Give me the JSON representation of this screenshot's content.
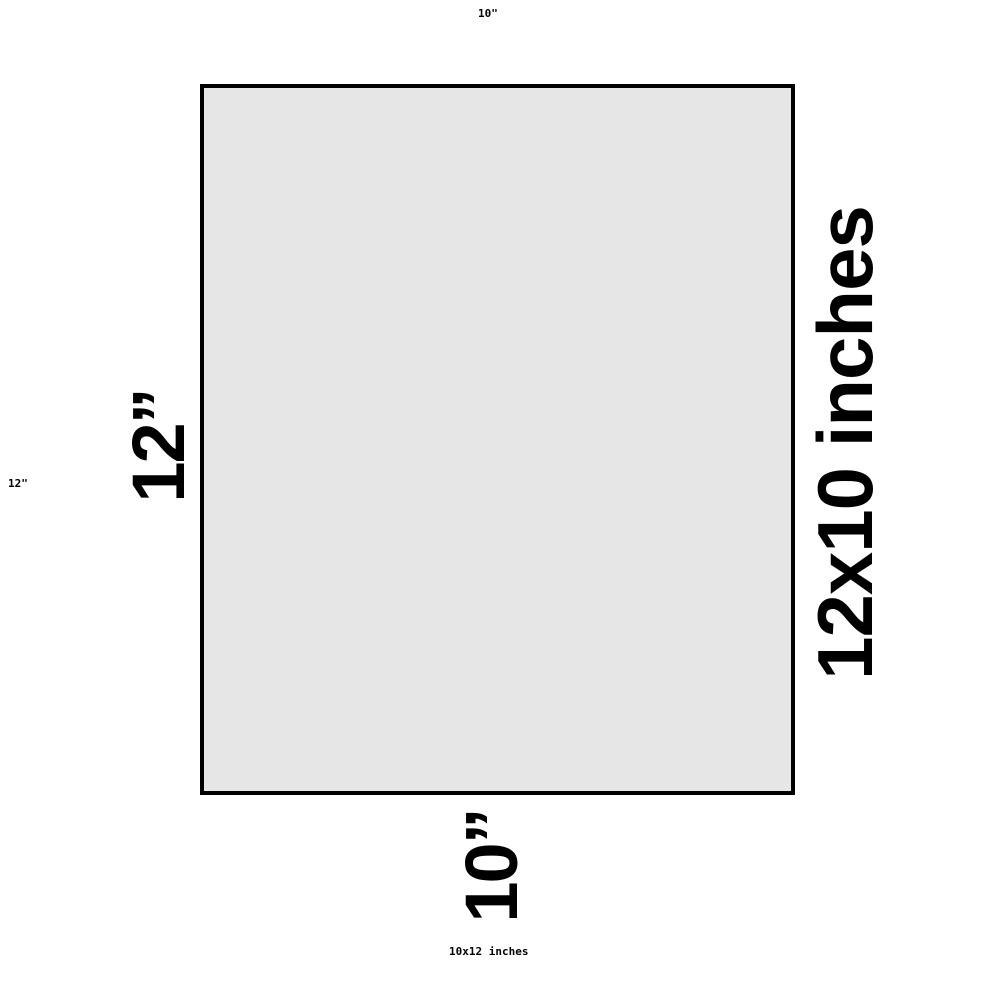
{
  "canvas": {
    "background": "#ffffff"
  },
  "rectangle": {
    "fill": "#e6e6e6",
    "border_color": "#000000"
  },
  "dimension_labels": {
    "height": "12”",
    "width": "10”",
    "size": "12x10 inches"
  },
  "margin_labels": {
    "top": "10\"",
    "left": "12\"",
    "bottom": "10x12 inches"
  },
  "text_color": "#000000"
}
